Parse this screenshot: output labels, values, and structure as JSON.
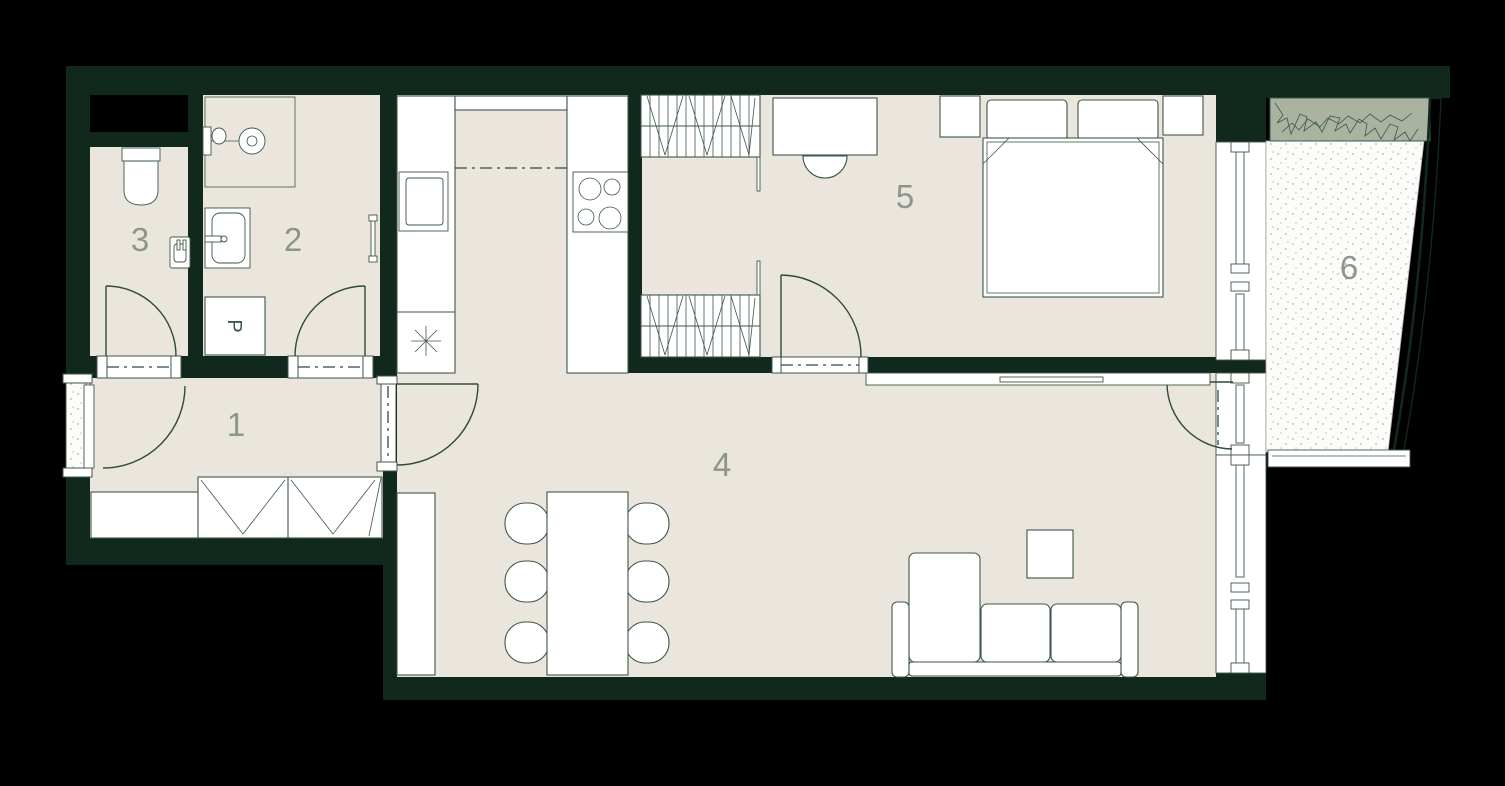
{
  "plan_labels": {
    "washer": "P"
  },
  "rooms": [
    {
      "label": "1"
    },
    {
      "label": "2"
    },
    {
      "label": "3"
    },
    {
      "label": "4"
    },
    {
      "label": "5"
    },
    {
      "label": "6"
    }
  ],
  "colors": {
    "background": "#000000",
    "wall": "#10291c",
    "floor": "#eae6dd",
    "furniture": "#ffffff",
    "outline": "#3e5747",
    "room_label": "#8d968b",
    "planter": "#a9b3a0",
    "balcony_floor": "#fcfcfa",
    "shaft": "#000000"
  }
}
